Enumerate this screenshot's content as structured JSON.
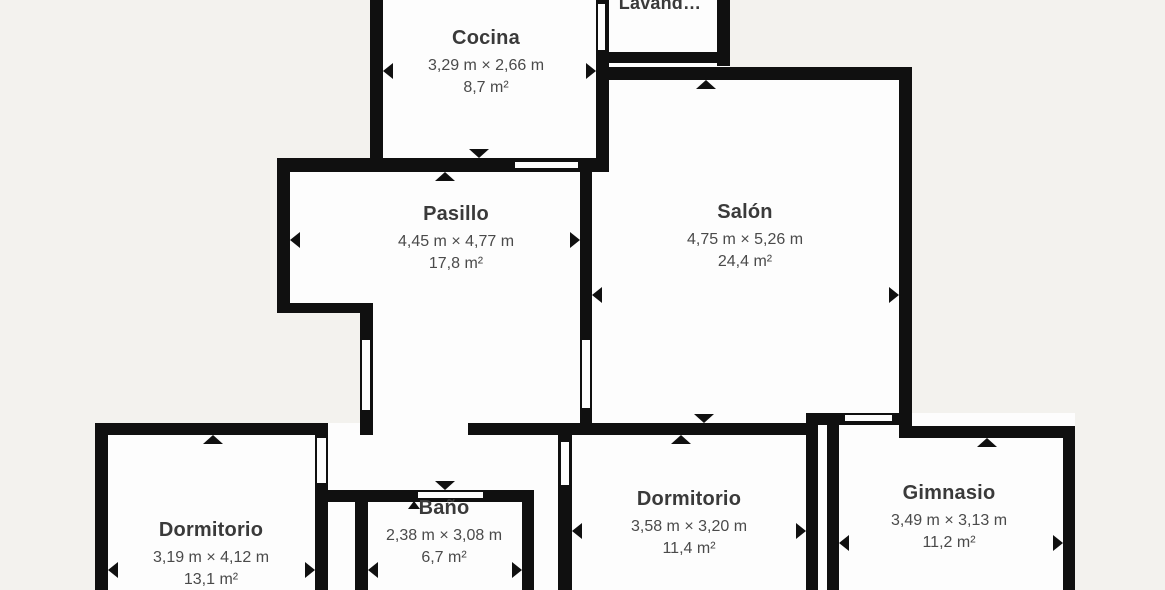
{
  "palette": {
    "background": "#f3f2ee",
    "wall": "#101010",
    "room_fill": "#fdfdfd",
    "text_title": "#3a3a3a",
    "text_dims": "#4a4a4a"
  },
  "rooms": [
    {
      "name": "Cocina",
      "dimensions": "3,29 m × 2,66 m",
      "area": "8,7 m²"
    },
    {
      "name": "Lavand…",
      "dimensions": "",
      "area": ""
    },
    {
      "name": "Pasillo",
      "dimensions": "4,45 m × 4,77 m",
      "area": "17,8 m²"
    },
    {
      "name": "Salón",
      "dimensions": "4,75 m × 5,26 m",
      "area": "24,4 m²"
    },
    {
      "name": "Dormitorio",
      "dimensions": "3,19 m × 4,12 m",
      "area": "13,1 m²"
    },
    {
      "name": "Baño",
      "dimensions": "2,38 m × 3,08 m",
      "area": "6,7 m²"
    },
    {
      "name": "Dormitorio",
      "dimensions": "3,58 m × 3,20 m",
      "area": "11,4 m²"
    },
    {
      "name": "Gimnasio",
      "dimensions": "3,49 m × 3,13 m",
      "area": "11,2 m²"
    }
  ]
}
